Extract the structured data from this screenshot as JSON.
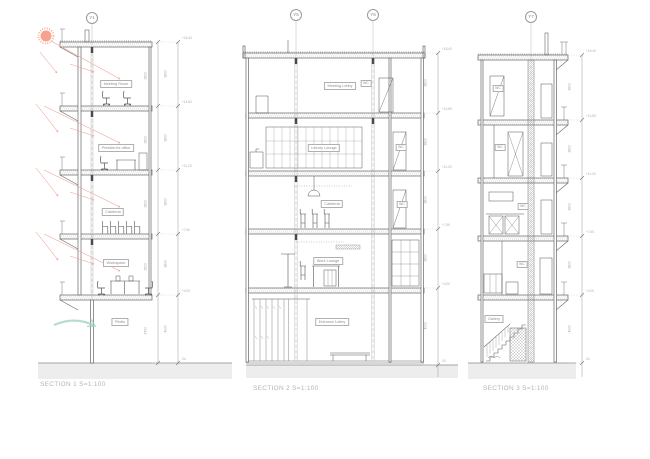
{
  "captions": {
    "s1": "SECTION 1 S=1:100",
    "s2": "SECTION 2 S=1:100",
    "s3": "SECTION 3 S=1:100"
  },
  "grid_markers": {
    "y1": "Y1",
    "y5": "Y5",
    "y6": "Y6",
    "y7": "Y7"
  },
  "rooms_s1": [
    "Meeting Room",
    "President's office",
    "Cafeteria",
    "Workspace",
    "Pilotis"
  ],
  "rooms_s2": [
    "Meeting Lobby",
    "Library Lounge",
    "Cafeteria",
    "Work Lounge",
    "Entrance Lobby"
  ],
  "wc_s2": [
    "WC",
    "WC",
    "WC"
  ],
  "labels_s3": [
    "WC",
    "WC",
    "WC",
    "WC",
    "Gallery"
  ],
  "dims_floor": [
    "3600",
    "3600",
    "3600",
    "3600",
    "4000"
  ],
  "dims_ceiling": [
    "2500",
    "2500",
    "2500",
    "2500",
    "3700"
  ],
  "levels": [
    "+18.40",
    "+14.80",
    "+11.20",
    "+7.60",
    "+4.00",
    "GL"
  ],
  "scale": "S=1:100",
  "colors": {
    "sun": "#f5a28f",
    "sun_ray": "#eda396",
    "breeze": "#9ecfc2",
    "ground": "#ededed",
    "line": "#666666",
    "label_text": "#8f8f8f",
    "caption_text": "#b5b5b5"
  }
}
